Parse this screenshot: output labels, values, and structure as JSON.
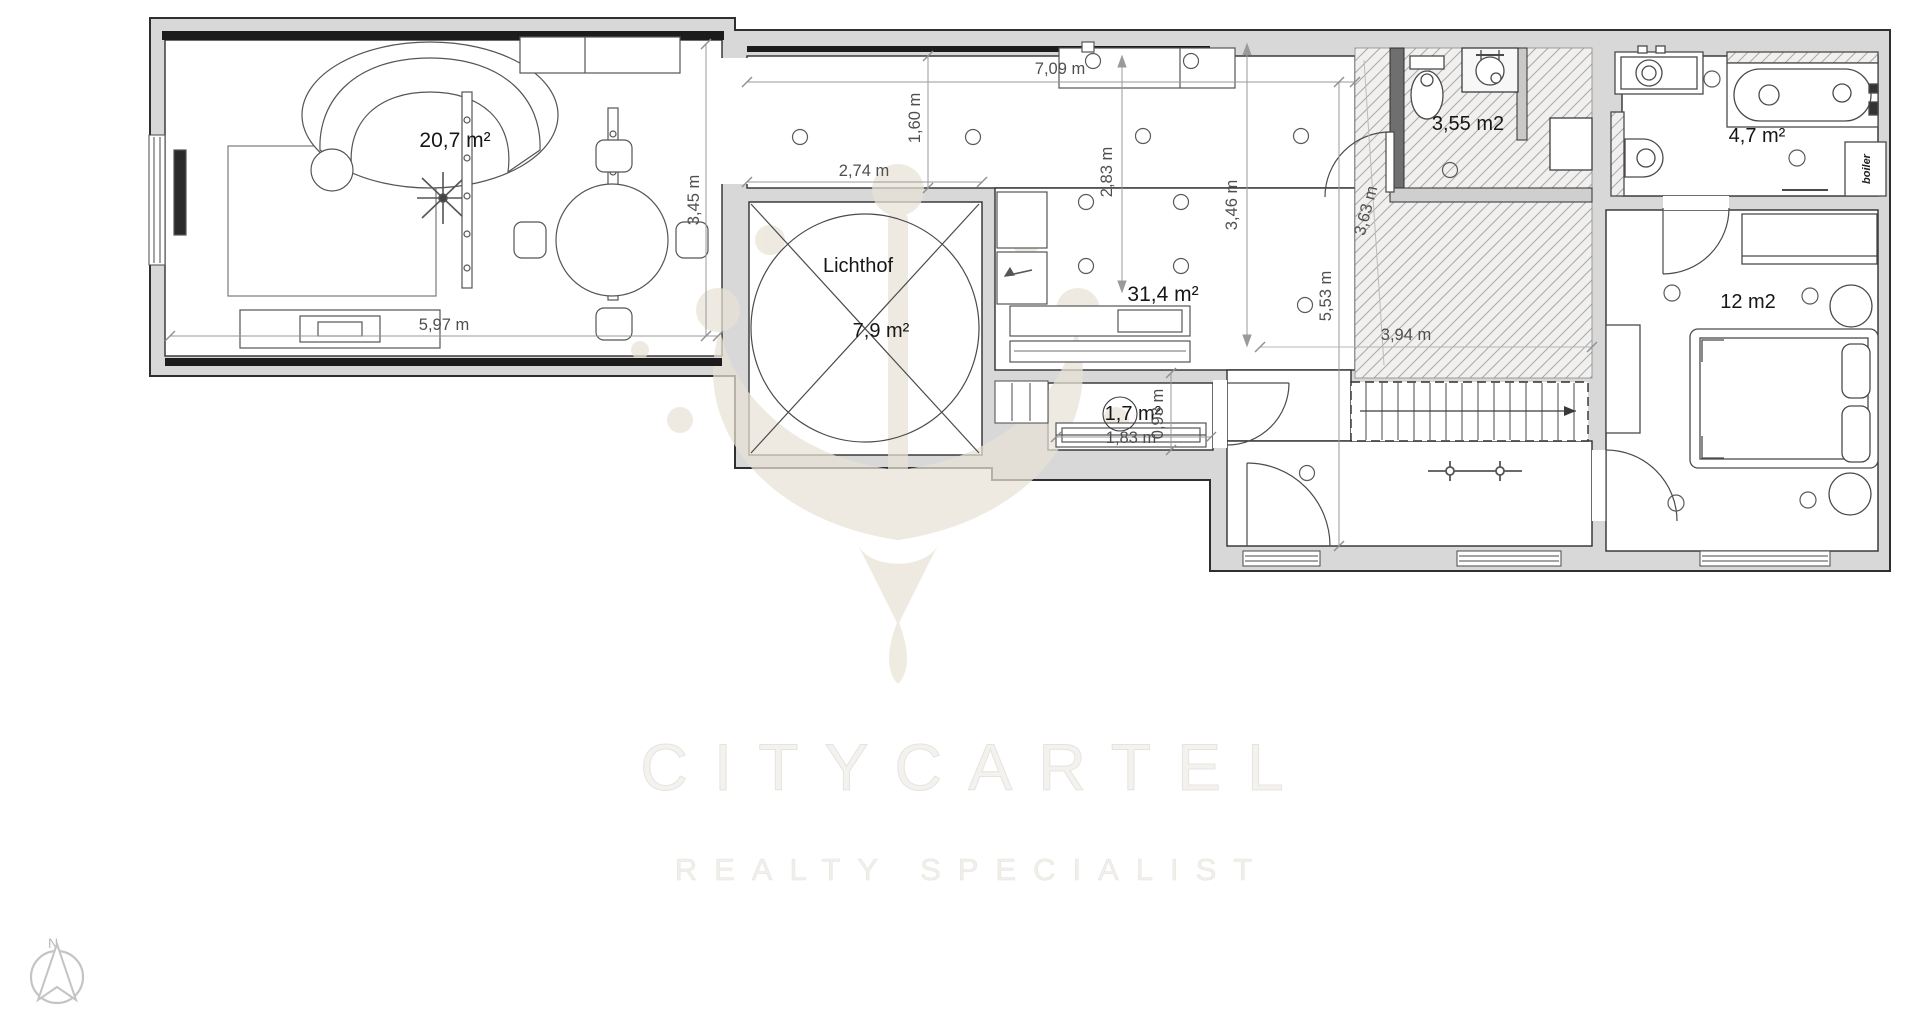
{
  "rooms": {
    "living": {
      "area": "20,7 m²"
    },
    "kitchen_living": {
      "area": "31,4 m²"
    },
    "lichthof": {
      "name": "Lichthof",
      "area": "7,9 m²"
    },
    "vestibule": {
      "area": "1,7 m²"
    },
    "wc": {
      "area": "3,55 m2"
    },
    "bathroom": {
      "area": "4,7 m²",
      "boiler_label": "boiler"
    },
    "bedroom": {
      "area": "12 m2"
    }
  },
  "dimensions": {
    "living_width": "5,97 m",
    "living_depth": "3,45 m",
    "corridor_width": "7,09 m",
    "corridor_depth": "1,60 m",
    "lichthof_width": "2,74 m",
    "kitchen_depth": "2,83 m",
    "hall_depth": "3,46 m",
    "hall_height": "5,53 m",
    "void_length": "3,63 m",
    "stair_length": "3,94 m",
    "vestibule_width": "1,83 m",
    "vestibule_depth": "0,93 m"
  },
  "watermark": {
    "brand": "CITYCARTEL",
    "tagline": "REALTY SPECIALIST"
  },
  "compass": {
    "north": "N"
  },
  "colors": {
    "wall_fill": "#d8d8d8",
    "line": "#2f2f2f",
    "hatch_line": "#a9a9a9",
    "watermark_beige": "#e9e3d6"
  }
}
